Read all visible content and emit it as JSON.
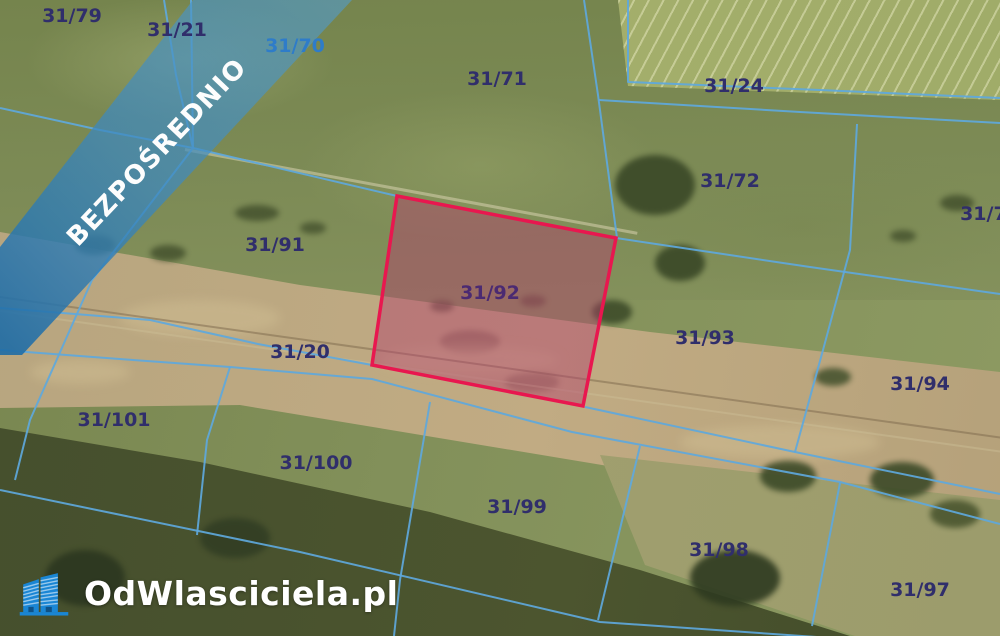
{
  "banner": {
    "text": "BEZPOŚREDNIO"
  },
  "logo": {
    "text": "OdWlasciciela.pl",
    "icon": "buildings-icon"
  },
  "map": {
    "type": "cadastral-aerial-photo",
    "highlighted_parcel": "31/92",
    "parcel_labels": [
      {
        "label": "31/79",
        "x": 72,
        "y": 16,
        "color": "#302e6b"
      },
      {
        "label": "31/21",
        "x": 177,
        "y": 30,
        "color": "#302e6b"
      },
      {
        "label": "31/70",
        "x": 295,
        "y": 46,
        "color": "#2e7cc9"
      },
      {
        "label": "31/71",
        "x": 497,
        "y": 79,
        "color": "#302e6b"
      },
      {
        "label": "31/24",
        "x": 734,
        "y": 86,
        "color": "#302e6b"
      },
      {
        "label": "31/72",
        "x": 730,
        "y": 181,
        "color": "#302e6b"
      },
      {
        "label": "31/73",
        "x": 990,
        "y": 214,
        "color": "#302e6b"
      },
      {
        "label": "31/91",
        "x": 275,
        "y": 245,
        "color": "#302e6b"
      },
      {
        "label": "31/92",
        "x": 490,
        "y": 293,
        "color": "#4b2a72"
      },
      {
        "label": "31/20",
        "x": 300,
        "y": 352,
        "color": "#302e6b"
      },
      {
        "label": "31/93",
        "x": 705,
        "y": 338,
        "color": "#302e6b"
      },
      {
        "label": "31/94",
        "x": 920,
        "y": 384,
        "color": "#302e6b"
      },
      {
        "label": "31/101",
        "x": 114,
        "y": 420,
        "color": "#302e6b"
      },
      {
        "label": "31/100",
        "x": 316,
        "y": 463,
        "color": "#302e6b"
      },
      {
        "label": "31/99",
        "x": 517,
        "y": 507,
        "color": "#302e6b"
      },
      {
        "label": "31/98",
        "x": 719,
        "y": 550,
        "color": "#302e6b"
      },
      {
        "label": "31/97",
        "x": 920,
        "y": 590,
        "color": "#302e6b"
      }
    ]
  },
  "colors": {
    "banner_blue": "#3c88bf",
    "banner_blue_dark": "#1e6ca6",
    "boundary_blue": "#5ea8dc",
    "highlight_border": "#e8174f",
    "highlight_fill": "rgba(178,62,108,0.45)",
    "label_navy": "#302e6b",
    "label_purple": "#4b2a72",
    "label_blue": "#2e7cc9",
    "logo_blue": "#1a86d4",
    "logo_text_color": "#ffffff"
  }
}
